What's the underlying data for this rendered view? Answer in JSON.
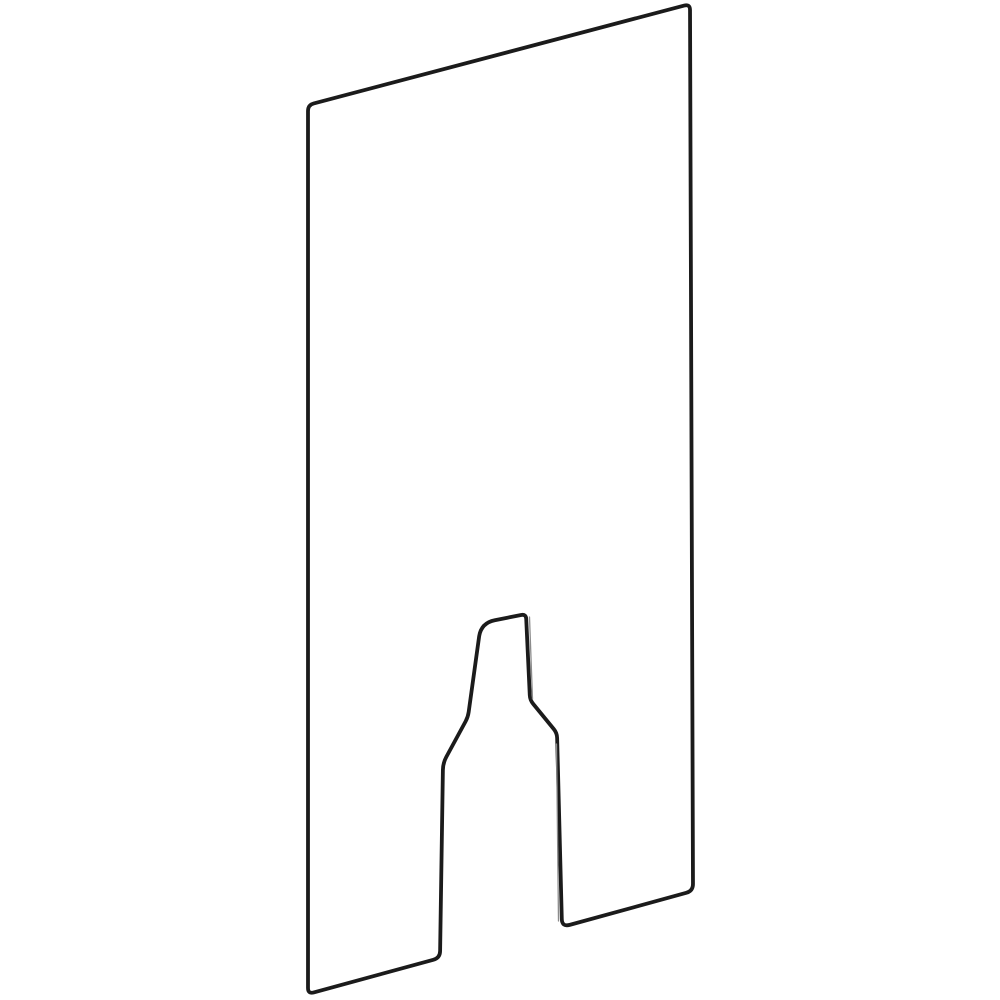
{
  "page": {
    "background": "#ffffff"
  },
  "figure": {
    "name": "glass-panel-with-keyhole-cutout-line-drawing",
    "description": "Tall flat panel drawn in slight perspective as a parallelogram with a bottle-shaped notch cut upward from the bottom edge",
    "canvas": {
      "width": 1000,
      "height": 1000
    },
    "stroke": {
      "color": "#1b1b1b",
      "width": 3.8
    },
    "hairline": {
      "color": "#8c8c8c",
      "width": 1.3
    },
    "outline_points": [
      {
        "x": 308,
        "y": 105,
        "r": 6
      },
      {
        "x": 690,
        "y": 4,
        "r": 6
      },
      {
        "x": 693,
        "y": 891,
        "r": 7
      },
      {
        "x": 562,
        "y": 927,
        "r": 8
      },
      {
        "x": 557,
        "y": 733,
        "r": 5
      },
      {
        "x": 530,
        "y": 700,
        "r": 5
      },
      {
        "x": 526,
        "y": 614,
        "r": 5
      },
      {
        "x": 481,
        "y": 623,
        "r": 14
      },
      {
        "x": 468,
        "y": 717,
        "r": 5
      },
      {
        "x": 443,
        "y": 763,
        "r": 7
      },
      {
        "x": 440,
        "y": 958,
        "r": 7
      },
      {
        "x": 308,
        "y": 994,
        "r": 6
      }
    ],
    "hairlines": [
      {
        "x1": 529.5,
        "y1": 617,
        "x2": 532.5,
        "y2": 699
      },
      {
        "x1": 556.5,
        "y1": 744,
        "x2": 558.5,
        "y2": 921
      }
    ]
  }
}
